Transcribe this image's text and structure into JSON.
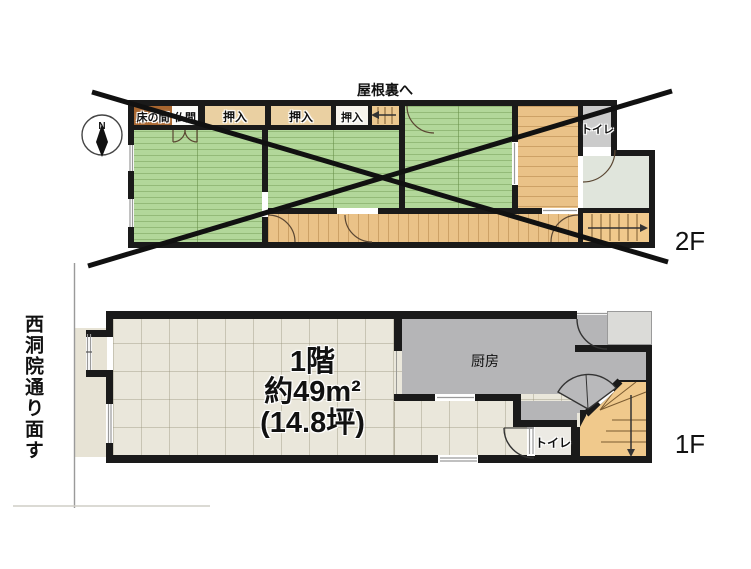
{
  "floor2f": {
    "attic_note": "屋根裏へ",
    "closets": {
      "tokonoma": "床の間",
      "butsuma": "仏間",
      "oshiire1": "押入",
      "oshiire2": "押入",
      "oshiire3": "押入"
    },
    "toilet_label": "トイレ",
    "floor_label": "2F"
  },
  "floor1f": {
    "area_line1": "1階",
    "area_line2": "約49m²",
    "area_line3": "(14.8坪)",
    "kitchen_label": "厨房",
    "toilet_label": "トイレ",
    "floor_label": "1F",
    "street_label": "西洞院通り面す"
  },
  "compass": {
    "north": "N"
  },
  "colors": {
    "wall": "#1a1a1a",
    "tatami": "#b2d79a",
    "wood": "#eac288",
    "tile": "#eae7db",
    "kitchen_gray": "#b5b5b7",
    "stairs_tan": "#f0c98c",
    "closet_tan": "#ead0a2",
    "tokonoma_brown": "#a8662f",
    "toilet2f_floor": "#cbcbcb",
    "anteroom": "#e0e5dc",
    "cross_line": "#111111"
  }
}
